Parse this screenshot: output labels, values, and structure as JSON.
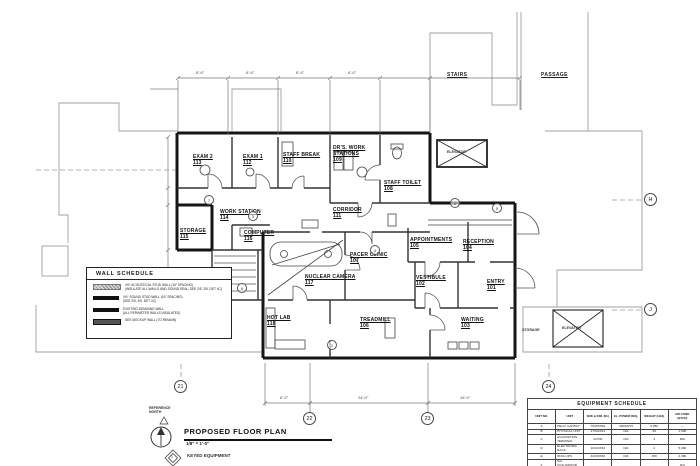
{
  "sheet": {
    "title": "PROPOSED FLOOR PLAN",
    "scale": "1/8\" = 1'-0\"",
    "north_label": "REFERENCE NORTH",
    "keyed_note": "KEYED EQUIPMENT",
    "keyed_digit": "1"
  },
  "rooms": [
    {
      "name": "EXAM 2",
      "number": "113"
    },
    {
      "name": "EXAM 1",
      "number": "112"
    },
    {
      "name": "STAFF BREAK",
      "number": "110"
    },
    {
      "name": "DR'S. WORK\nSTATIONS",
      "number": "109"
    },
    {
      "name": "STAFF TOILET",
      "number": "108"
    },
    {
      "name": "CORRIDOR",
      "number": "111"
    },
    {
      "name": "WORK STATION",
      "number": "114"
    },
    {
      "name": "STORAGE",
      "number": "115"
    },
    {
      "name": "COMPUTER",
      "number": "116"
    },
    {
      "name": "PACER CLINIC",
      "number": "107"
    },
    {
      "name": "NUCLEAR CAMERA",
      "number": "117"
    },
    {
      "name": "APPOINTMENTS",
      "number": "105"
    },
    {
      "name": "RECEPTION",
      "number": "104"
    },
    {
      "name": "VESTIBULE",
      "number": "102"
    },
    {
      "name": "ENTRY",
      "number": "101"
    },
    {
      "name": "HOT LAB",
      "number": "118"
    },
    {
      "name": "TREADMILL",
      "number": "106"
    },
    {
      "name": "WAITING",
      "number": "103"
    }
  ],
  "areas": {
    "stairs": "STAIRS",
    "passage": "PASSAGE",
    "elevator_top": "ELEVATOR",
    "elevator_right": "ELEVATOR",
    "storage_right": "STORAGE"
  },
  "grid": {
    "h": "H",
    "j": "J",
    "c21": "21",
    "c22": "22",
    "c23": "23",
    "c24": "24"
  },
  "dimensions": {
    "top": [
      "8'-6\"",
      "8'-6\"",
      "8'-6\"",
      "6'-0\""
    ],
    "bottom": [
      "8'-0\"",
      "24'-0\"",
      "16'-0\""
    ]
  },
  "keyed_markers": [
    "1",
    "2",
    "3",
    "4",
    "5",
    "6",
    "7"
  ],
  "wall_schedule": {
    "title": "WALL SCHEDULE",
    "items": [
      {
        "line1": "4½\" ACOUSTICAL STUD WALL (16\" SPACING)",
        "line2": "(INSULATE ALL WALLS AND SOUND SEAL; SEE 2/5, 3/5, DET 4C)"
      },
      {
        "line1": "4½\" SOUND STUD WALL (16\" SPACING)",
        "line2": "(SEE 2/5, 3/5, DET 4C)"
      },
      {
        "line1": "EXISTING DEMISING WALL",
        "line2": "(ALL PERIMETER WALLS INSULATED)"
      },
      {
        "line1": "SEE MOCKUP WALL (TO REMAIN)",
        "line2": ""
      }
    ]
  },
  "equipment_schedule": {
    "title": "EQUIPMENT SCHEDULE",
    "columns": [
      "UNIT NO.",
      "UNIT",
      "SIZE & DIM. (IN.)",
      "EL. POWER REQ.",
      "WEIGHT (LBS)",
      "AIR COND. (BTUH)"
    ],
    "rows": [
      [
        "A",
        "HELIX GANTRY",
        "70X55X66",
        "280/60/75",
        "6,950",
        "—"
      ],
      [
        "B",
        "PHYSICAL UNIT",
        "17X22X41",
        "N/A",
        "50",
        "1,500"
      ],
      [
        "C",
        "ACQUISITION TERMINAL",
        "22X30",
        "N/A",
        "4",
        "900"
      ],
      [
        "D",
        "ELECTRONIC RACK",
        "22X24X34",
        "N/A",
        "4",
        "5,000"
      ],
      [
        "E",
        "8KVA UPS",
        "44X30X60",
        "N/A",
        "450",
        "2,380"
      ],
      [
        "F",
        "S/A COLLIMATOR STORAGE",
        "",
        "",
        "",
        "N/A"
      ]
    ]
  }
}
